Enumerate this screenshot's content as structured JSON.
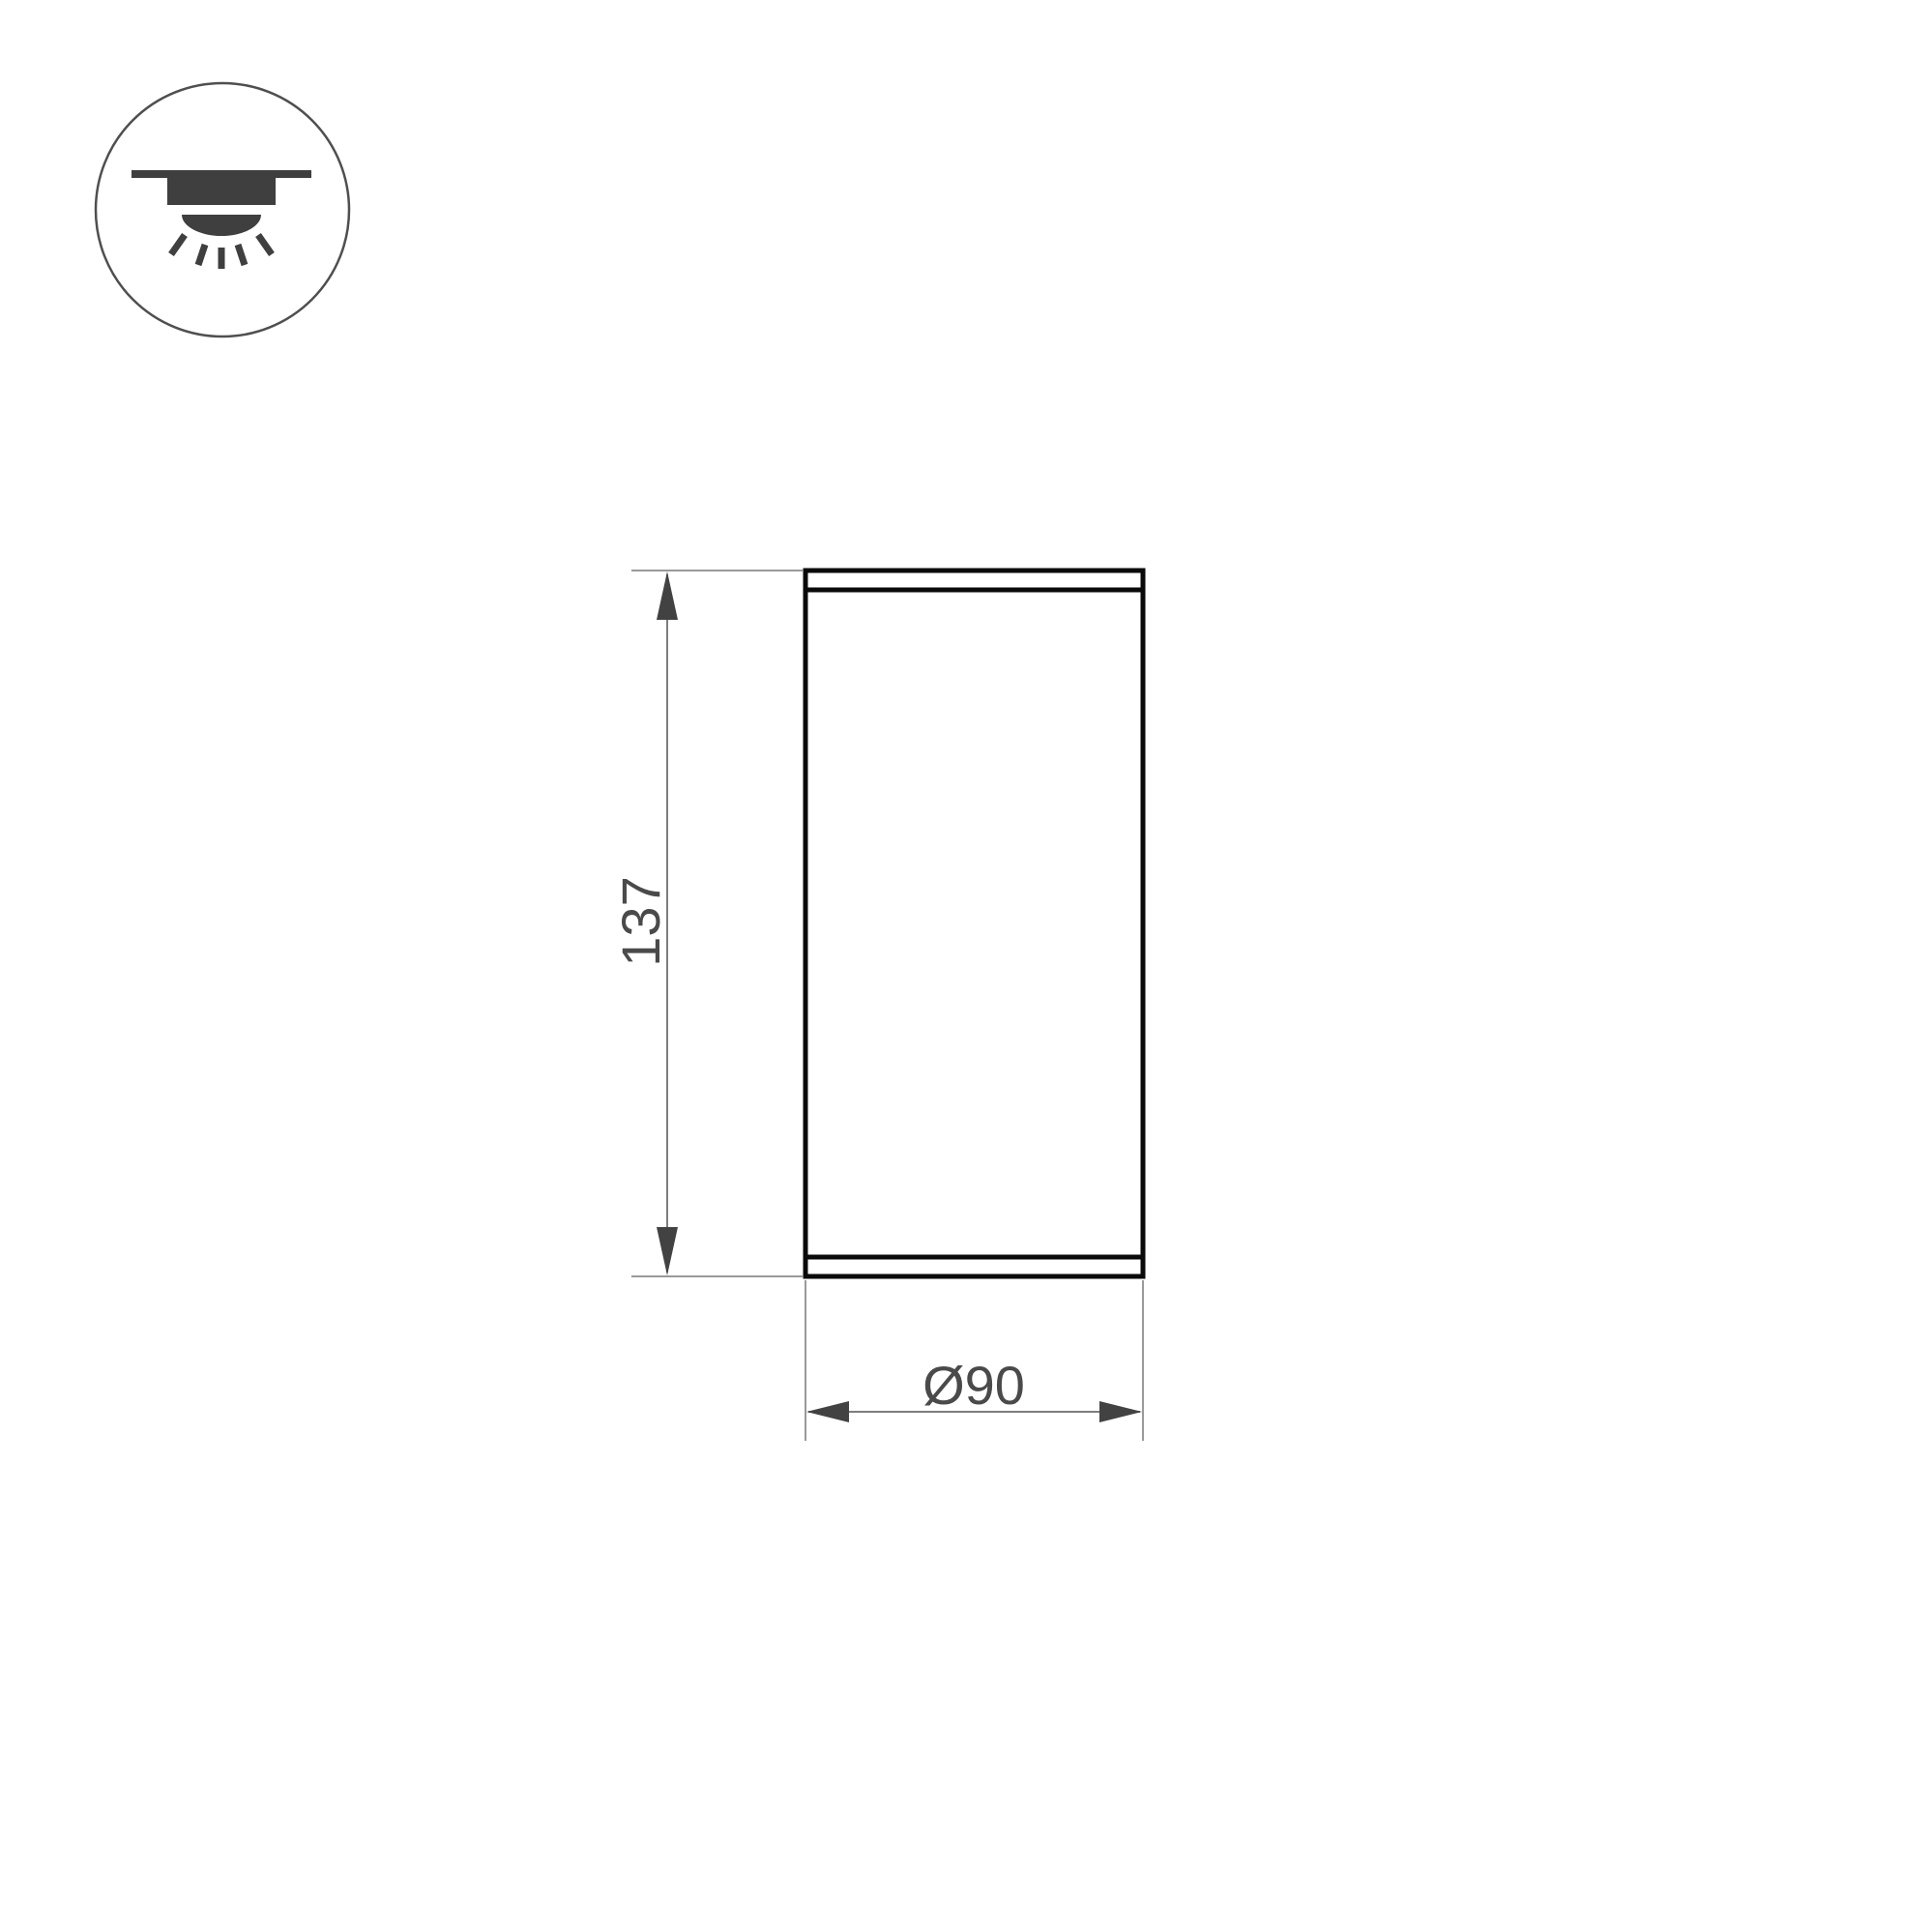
{
  "page": {
    "background_color": "#ffffff"
  },
  "icon": {
    "type": "recessed-ceiling-downlight",
    "ring_color": "#4f4f4f",
    "glyph_color": "#3f3f3f"
  },
  "drawing": {
    "body_line_color": "#0a0a0a",
    "extension_line_color": "#9a9a9a",
    "dimension_line_color": "#7d7d7d",
    "arrow_color": "#424242",
    "text_color": "#4a4a4a",
    "height_dimension": {
      "label": "137",
      "value": 137
    },
    "diameter_dimension": {
      "label": "Ø90",
      "value": 90
    }
  }
}
